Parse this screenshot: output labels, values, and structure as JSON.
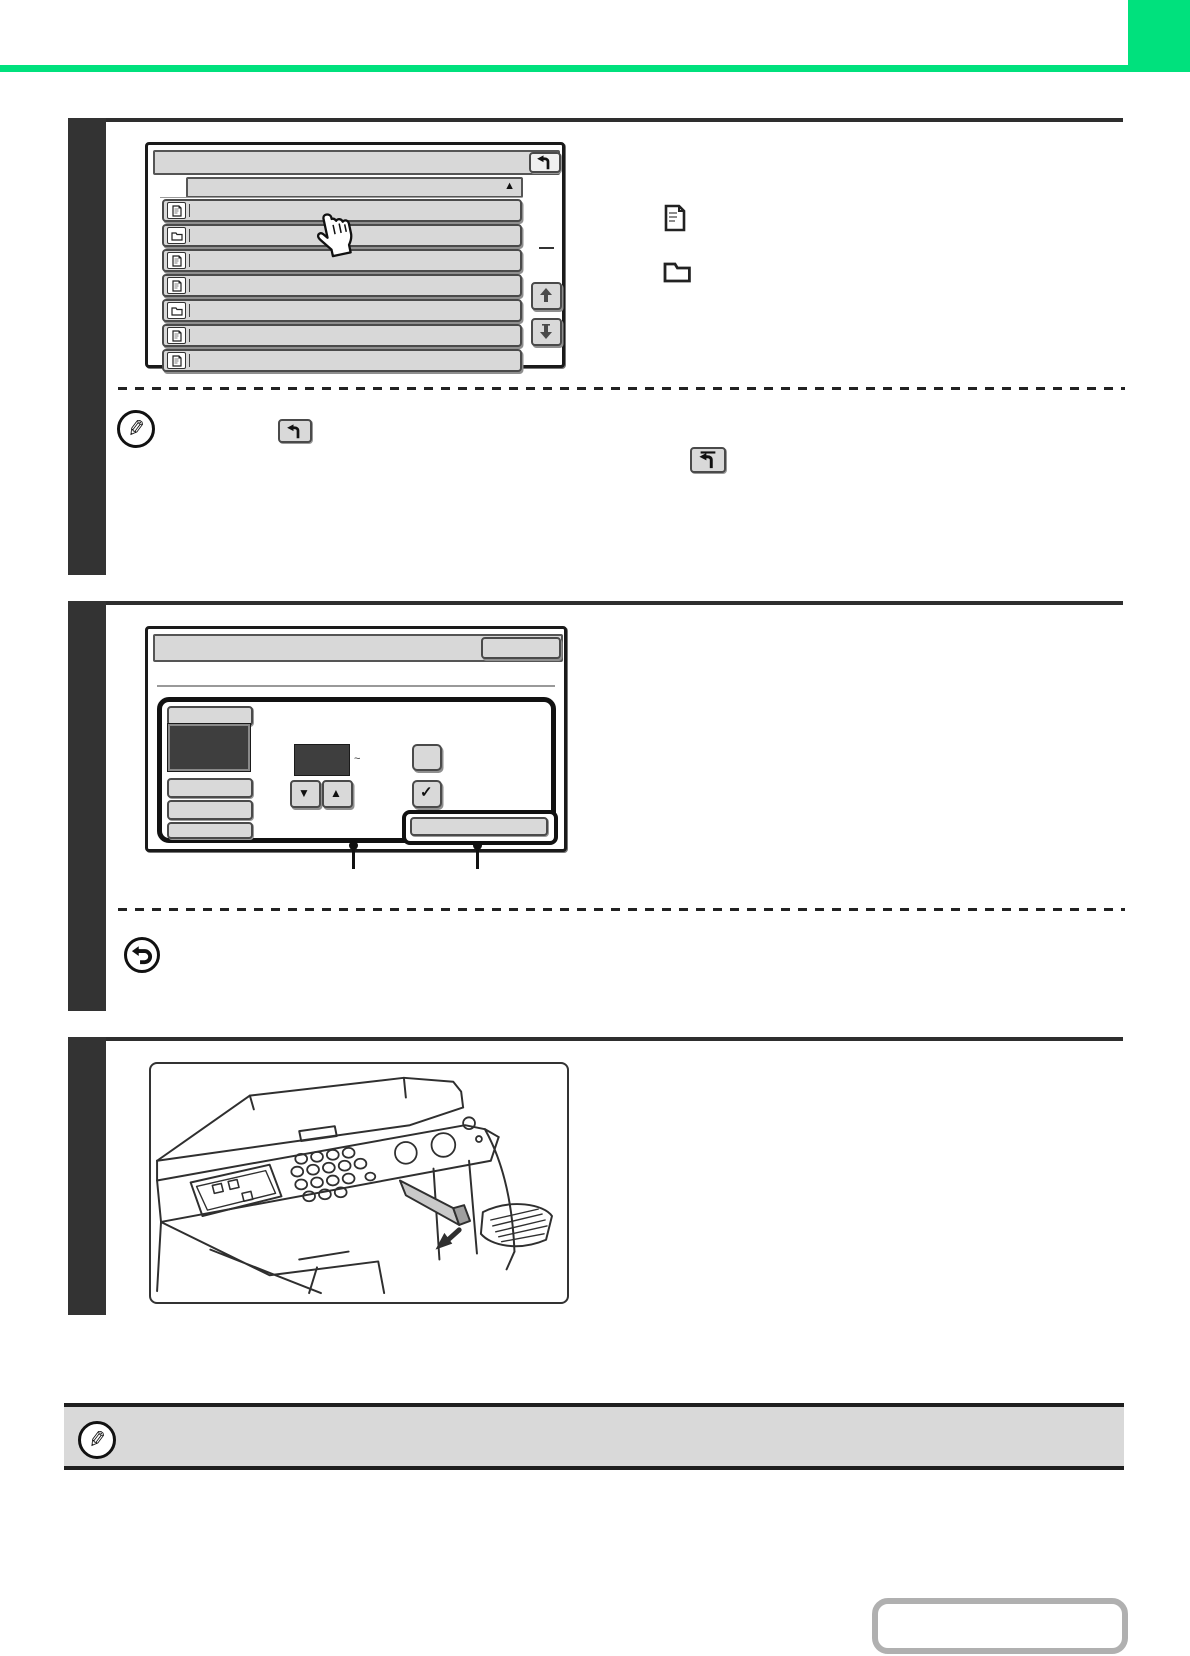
{
  "palette": {
    "accent_green": "#00E17D",
    "step_block_dark": "#333333",
    "panel_border": "#1a1a1a",
    "key_fill": "#d8d8d8",
    "dark_display": "#3e3e3e",
    "note_band_fill": "#d9d9d9",
    "nav_box_border": "#b0b0b0"
  },
  "glyphs": {
    "sort_ascending": "▲",
    "spinner_down": "▼",
    "spinner_up": "▲",
    "checkmark": "✓",
    "tilde": "~",
    "pencil": "✎"
  },
  "header": {
    "elements": [
      "green-corner-block",
      "green-rule"
    ]
  },
  "step_1": {
    "touch_screen": {
      "title_bar_key_icon": "return-up-one-level-icon",
      "sort_bar_icon": "sort-ascending-triangle",
      "file_rows": [
        {
          "icon": "file"
        },
        {
          "icon": "folder"
        },
        {
          "icon": "file"
        },
        {
          "icon": "file"
        },
        {
          "icon": "folder"
        },
        {
          "icon": "file"
        },
        {
          "icon": "file"
        }
      ],
      "scroll_keys": [
        "scroll-up-key",
        "scroll-down-key"
      ],
      "cursor": "pointing-hand"
    },
    "legend_icons": [
      "file-icon",
      "folder-icon"
    ],
    "note": {
      "icon": "pencil-note-icon",
      "inline_keys": [
        "return-up-one-level-key",
        "return-to-root-key"
      ]
    }
  },
  "step_2": {
    "touch_screen": {
      "header_key": "header-right-key",
      "left_column": [
        "tab-key",
        "preview-display",
        "key",
        "key",
        "key"
      ],
      "copies_display": "dark-number-display",
      "spinner_keys": [
        "decrease-key",
        "increase-key"
      ],
      "option_keys": [
        "checkbox-key",
        "confirm-check-key"
      ],
      "action_key": "emphasized-key",
      "callout_count": 2
    },
    "note": {
      "icon": "back-arrow-note-icon"
    }
  },
  "step_3": {
    "illustration": "removing-usb-memory-from-machine",
    "elements": [
      "document-feeder",
      "control-panel",
      "touch-panel-display",
      "keypad-keys",
      "usb-memory-stick",
      "exit-tray",
      "removal-arrow"
    ]
  },
  "footer_note": {
    "icon": "pencil-note-icon"
  },
  "footer_nav": {
    "shape": "rounded-outline-box"
  }
}
